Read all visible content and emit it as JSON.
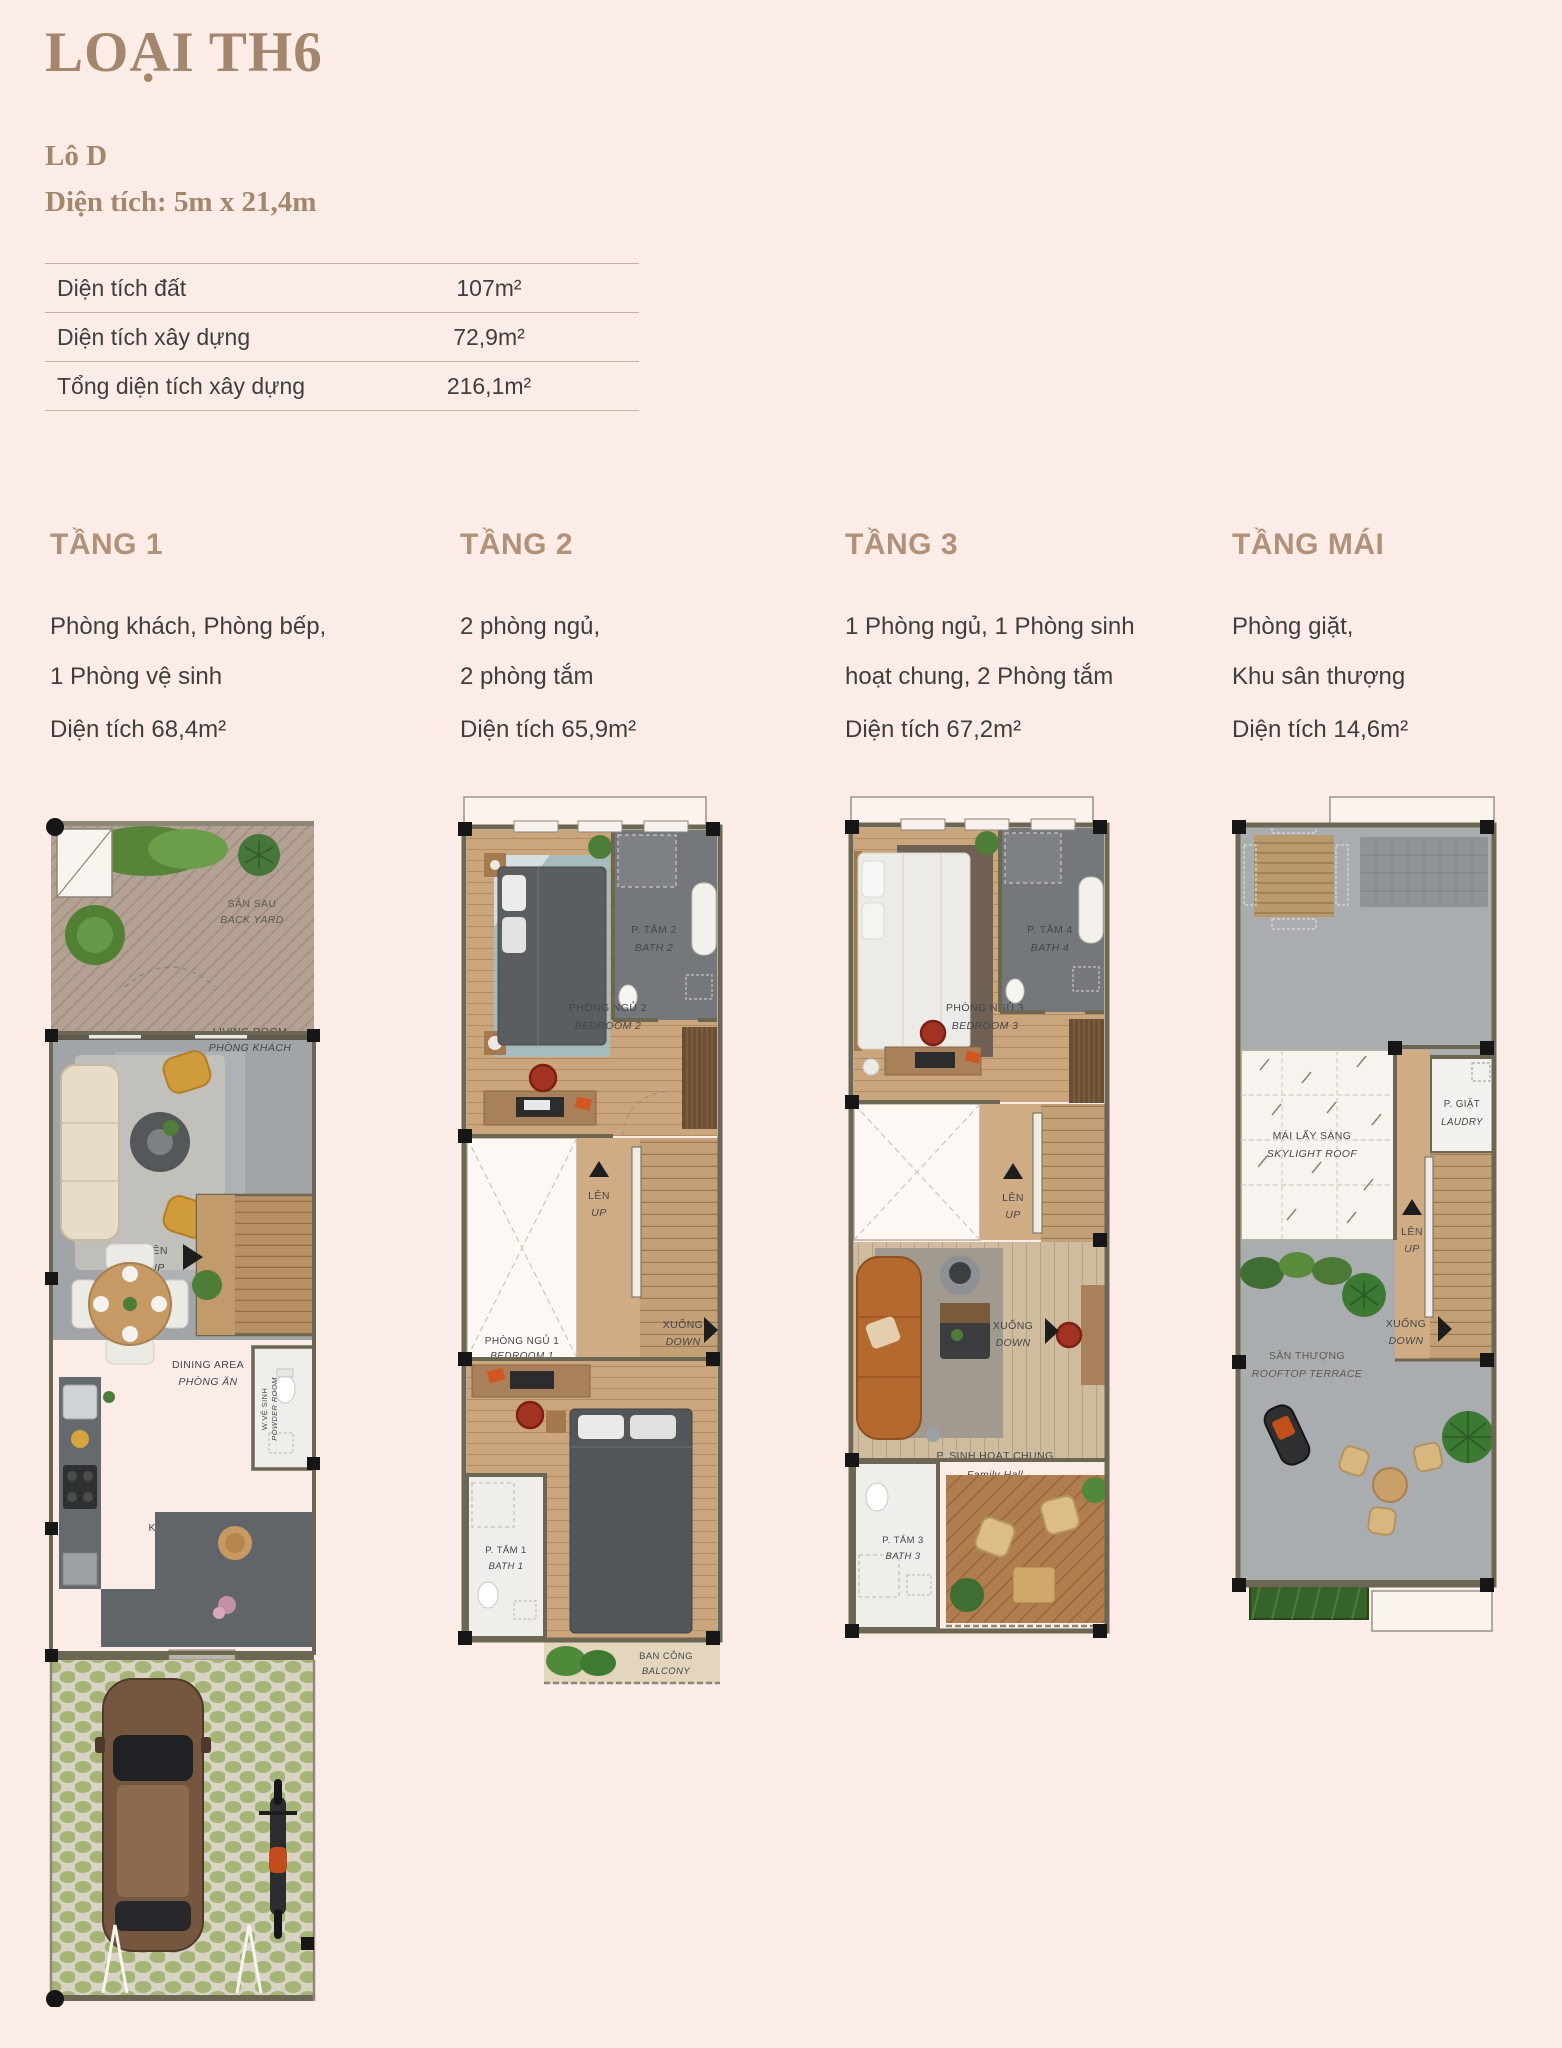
{
  "page": {
    "background": "#fcece8",
    "accent_serif_brown": "#a3866c",
    "heading_brown": "#b29179",
    "text_dark": "#3e3e3e",
    "wall_color": "#6c6753",
    "title": "LOẠI TH6",
    "lot": "Lô D",
    "dimensions": "Diện tích: 5m x 21,4m"
  },
  "area_table": {
    "rows": [
      {
        "label": "Diện tích đất",
        "value": "107m²"
      },
      {
        "label": "Diện tích xây dựng",
        "value": "72,9m²"
      },
      {
        "label": "Tổng diện tích xây dựng",
        "value": "216,1m²"
      }
    ]
  },
  "floors": [
    {
      "name": "TẦNG 1",
      "desc1": "Phòng khách, Phòng bếp,",
      "desc2": "1 Phòng vệ sinh",
      "area": "Diện tích 68,4m²"
    },
    {
      "name": "TẦNG 2",
      "desc1": "2 phòng ngủ,",
      "desc2": "2 phòng tắm",
      "area": "Diện tích 65,9m²"
    },
    {
      "name": "TẦNG 3",
      "desc1": "1 Phòng ngủ, 1 Phòng sinh",
      "desc2": "hoạt chung, 2 Phòng tắm",
      "area": "Diện tích 67,2m²"
    },
    {
      "name": "TẦNG MÁI",
      "desc1": "Phòng giặt,",
      "desc2": "Khu sân thượng",
      "area": "Diện tích 14,6m²"
    }
  ],
  "plans": {
    "floor1": {
      "backyard_vi": "SÂN SAU",
      "backyard_en": "BACK YARD",
      "living_en": "LIVING ROOM",
      "living_vi": "PHÒNG KHÁCH",
      "up_vi": "LÊN",
      "up_en": "UP",
      "dining_en": "DINING AREA",
      "dining_vi": "PHÒNG ĂN",
      "powder_vi": "W.VỆ SINH",
      "powder_en": "POWDER ROOM",
      "kitchen_en": "KITCHEN",
      "kitchen_vi": "BẾP"
    },
    "floor2": {
      "bath2_vi": "P. TẮM 2",
      "bath2_en": "BATH 2",
      "bedroom2_vi": "PHÒNG NGỦ 2",
      "bedroom2_en": "BEDROOM 2",
      "up_vi": "LÊN",
      "up_en": "UP",
      "down_vi": "XUỐNG",
      "down_en": "DOWN",
      "bedroom1_vi": "PHÒNG NGỦ 1",
      "bedroom1_en": "BEDROOM 1",
      "bath1_vi": "P. TẮM 1",
      "bath1_en": "BATH 1",
      "balcony_vi": "BAN CÔNG",
      "balcony_en": "BALCONY"
    },
    "floor3": {
      "bath4_vi": "P. TẮM 4",
      "bath4_en": "BATH 4",
      "bedroom3_vi": "PHÒNG NGỦ 3",
      "bedroom3_en": "BEDROOM 3",
      "up_vi": "LÊN",
      "up_en": "UP",
      "down_vi": "XUỐNG",
      "down_en": "DOWN",
      "family_vi": "P. SINH HOẠT CHUNG",
      "family_en": "Family Hall",
      "bath3_vi": "P. TẮM 3",
      "bath3_en": "BATH 3"
    },
    "roof": {
      "skylight_vi": "MÁI LẤY SÁNG",
      "skylight_en": "SKYLIGHT ROOF",
      "laundry_vi": "P. GIẶT",
      "laundry_en": "LAUDRY",
      "up_vi": "LÊN",
      "up_en": "UP",
      "down_vi": "XUỐNG",
      "down_en": "DOWN",
      "terrace_vi": "SÂN THƯỢNG",
      "terrace_en": "ROOFTOP TERRACE"
    }
  }
}
